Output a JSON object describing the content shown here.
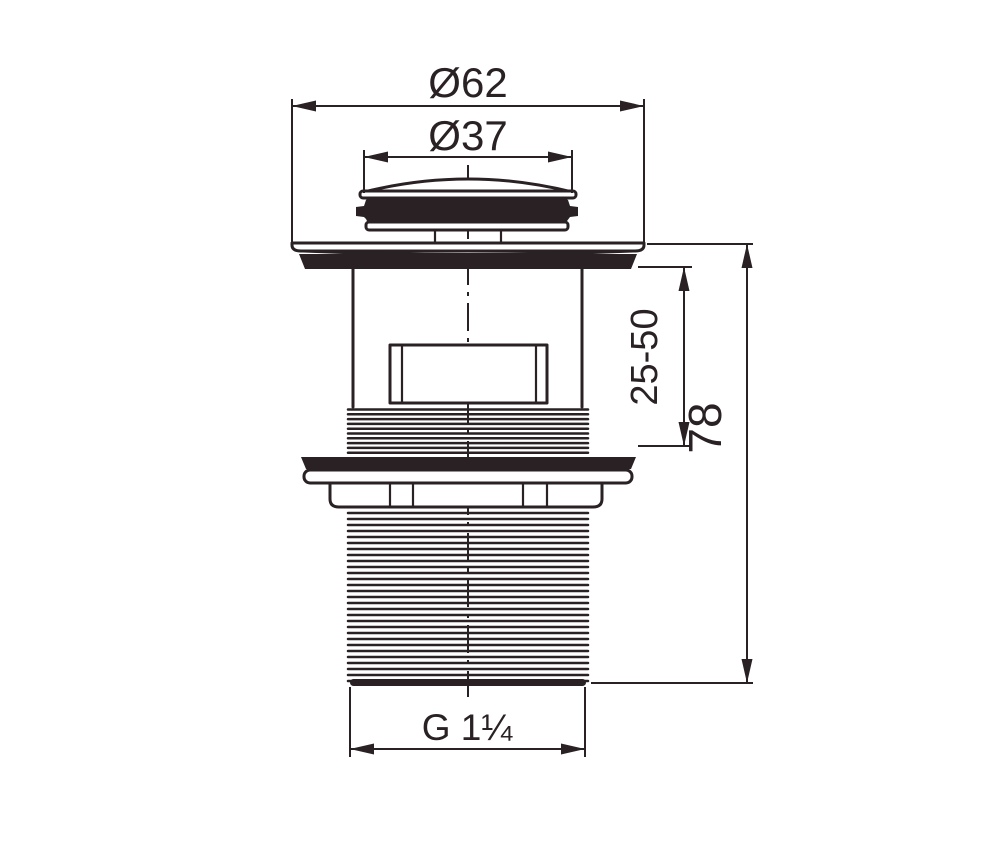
{
  "drawing": {
    "background": "#ffffff",
    "ink": "#292123",
    "dimensions": {
      "outer_diameter": {
        "label": "Ø62"
      },
      "cap_diameter": {
        "label": "Ø37"
      },
      "clamp_range": {
        "label": "25-50"
      },
      "overall_height": {
        "label": "78"
      },
      "thread_size": {
        "label": "G 1¼"
      }
    }
  }
}
